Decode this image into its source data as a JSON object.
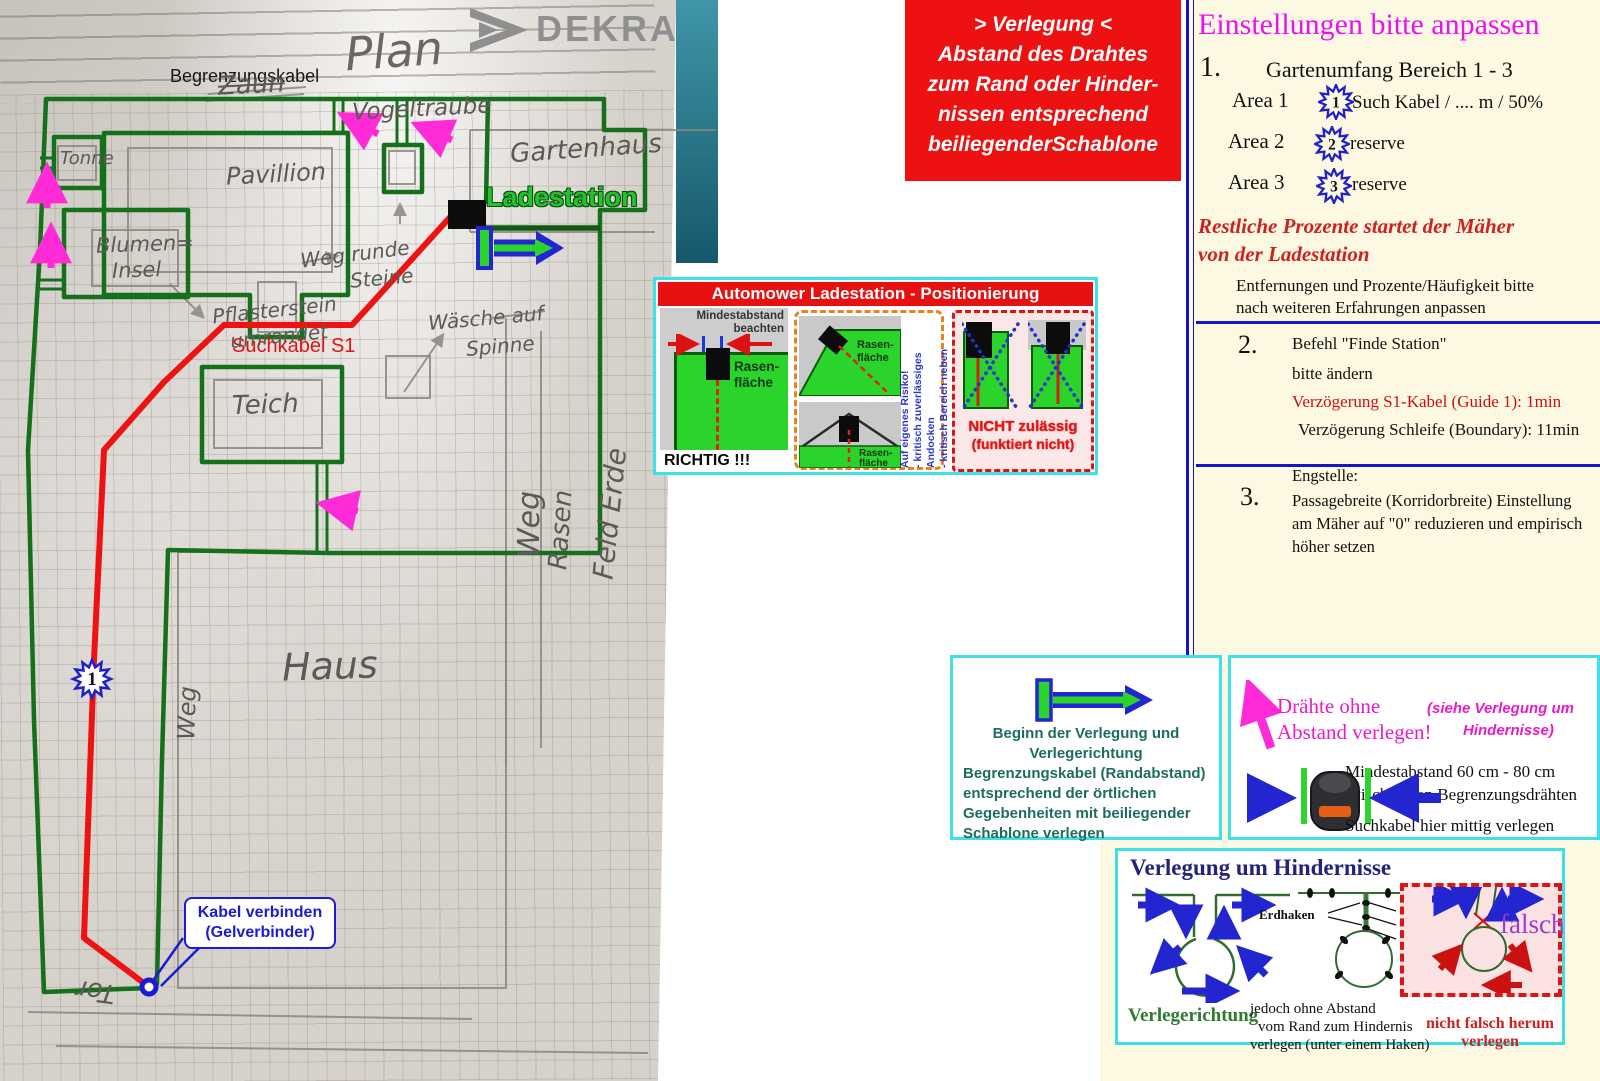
{
  "colors": {
    "accent_cyan": "#3ddfe8",
    "cable_green": "#15701c",
    "cable_red": "#ee1212",
    "magenta_arrow": "#ff2bd6",
    "note_red_bg": "#ee1111",
    "cream_bg": "#fdf8e1",
    "blue_accent": "#1b1bd6",
    "title_magenta": "#ee10ee"
  },
  "plan": {
    "dekra": "DEKRA",
    "labels": {
      "begrenzungskabel": "Begrenzungskabel",
      "ladestation": "Ladestation",
      "suchkabel": "Suchkabel S1",
      "kabel_1": "Kabel verbinden",
      "kabel_2": "(Gelverbinder)",
      "star": "1"
    },
    "handwritten": {
      "plan": "Plan",
      "zaun": "Zaun",
      "vogeltraube": "Vogeltraube",
      "gartenhaus": "Gartenhaus",
      "pavillion": "Pavillion",
      "tonne": "Tonne",
      "blumen_1": "Blumen=",
      "blumen_2": "Insel",
      "weg_runde": "Weg runde",
      "steine": "Steine",
      "pflaster_1": "Pflasterstein",
      "pflaster_2": "umrandet",
      "waesche": "Wäsche auf",
      "spinne": "Spinne",
      "teich": "Teich",
      "weg_seite": "Weg",
      "rasen": "Rasen",
      "feld_erde": "Feld Erde",
      "weg_haus": "Weg",
      "haus": "Haus",
      "tor": "Tor"
    }
  },
  "verlegung_note": {
    "lines": [
      "> Verlegung <",
      "Abstand des Drahtes",
      "zum Rand oder Hinder-",
      "nissen entsprechend",
      "beiliegenderSchablone"
    ]
  },
  "automower_panel": {
    "title": "Automower Ladestation - Positionierung",
    "mindestabstand_1": "Mindestabstand",
    "mindestabstand_2": "beachten",
    "rasen_1a": "Rasen-",
    "rasen_1b": "fläche",
    "rasen_2a": "Rasen-",
    "rasen_2b": "fläche",
    "rasen_3a": "Rasen-",
    "rasen_3b": "fläche",
    "richtig": "RICHTIG !!!",
    "risiko_lines": [
      "Auf eigenes Risiko!",
      "- kritisch zuverlässiges Andocken",
      "- kritisch Bereich neben Ladestation"
    ],
    "nicht_1": "NICHT zulässig",
    "nicht_2": "(funktiert nicht)"
  },
  "einstellungen": {
    "title": "Einstellungen bitte anpassen",
    "item1_number": "1.",
    "item1_text": "Gartenumfang Bereich 1 - 3",
    "areas": [
      {
        "label": "Area 1",
        "badge": "1",
        "value": "Such Kabel / .... m / 50%"
      },
      {
        "label": "Area 2",
        "badge": "2",
        "value": "reserve"
      },
      {
        "label": "Area 3",
        "badge": "3",
        "value": "reserve"
      }
    ],
    "note_red_1": "Restliche Prozente  startet der Mäher",
    "note_red_2": "von der Ladestation",
    "note_1": "Entfernungen und Prozente/Häufigkeit bitte",
    "note_2": "nach weiteren Erfahrungen anpassen",
    "item2_number": "2.",
    "item2_line_1": "Befehl \"Finde Station\"",
    "item2_line_2": "bitte ändern",
    "item2_red": "Verzögerung S1-Kabel (Guide 1): 1min",
    "item2_line_4": "Verzögerung Schleife (Boundary): 11min",
    "item3_number": "3.",
    "item3_line_1": "Engstelle:",
    "item3_line_2": "Passagebreite (Korridorbreite) Einstellung",
    "item3_line_3": "am Mäher auf \"0\" reduzieren und empirisch",
    "item3_line_4": "höher setzen"
  },
  "beginn_panel": {
    "lines": [
      "Beginn der Verlegung und",
      "Verlegerichtung",
      "Begrenzungskabel (Randabstand)",
      "entsprechend der örtlichen",
      "Gegebenheiten mit beiliegender",
      "Schablone verlegen"
    ]
  },
  "draehte_panel": {
    "line_1": "Drähte ohne",
    "line_2": "Abstand verlegen!",
    "see_1": "(siehe Verlegung um",
    "see_2": "Hindernisse)",
    "mind_1": "Mindestabstand 60 cm - 80 cm",
    "mind_2": "zwischen den Begrenzungsdrähten",
    "such": "Suchkabel hier mittig verlegen"
  },
  "hindernisse_panel": {
    "title": "Verlegung um Hindernisse",
    "erdhaken": "Erdhaken",
    "mit_null_1": "Mit Null",
    "mit_null_2": "Abstand",
    "mit_null_3": "verlegen",
    "verlegerichtung": "Verlegerichtung",
    "jedoch_1": "jedoch ohne Abstand",
    "jedoch_2": "vom Rand zum Hindernis",
    "jedoch_3": "verlegen (unter einem Haken)",
    "falsch": "falsch",
    "nicht_1": "nicht falsch herum",
    "nicht_2": "verlegen"
  }
}
